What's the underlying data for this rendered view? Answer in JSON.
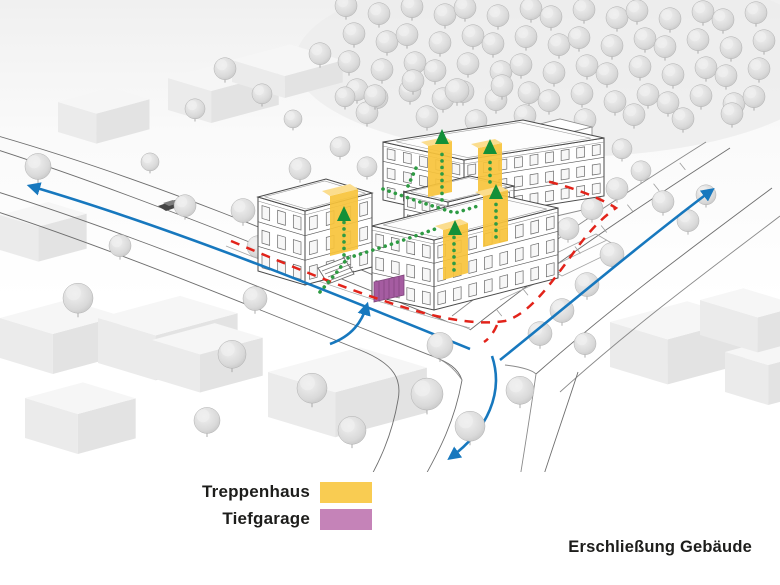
{
  "diagram": {
    "title": "Erschließung Gebäude",
    "legend": {
      "items": [
        {
          "id": "treppenhaus",
          "label": "Treppenhaus",
          "color": "#F9CC52"
        },
        {
          "id": "tiefgarage",
          "label": "Tiefgarage",
          "color": "#C583B8"
        }
      ]
    },
    "annotations": {
      "car_route_color": "#1778BE",
      "pedestrian_route_color": "#E2231A",
      "building_access_color": "#2E9B43",
      "access_arrow_color": "#149038",
      "staircase_highlight_color": "#F7C33B",
      "garage_door_color": "#A55CA1"
    }
  }
}
